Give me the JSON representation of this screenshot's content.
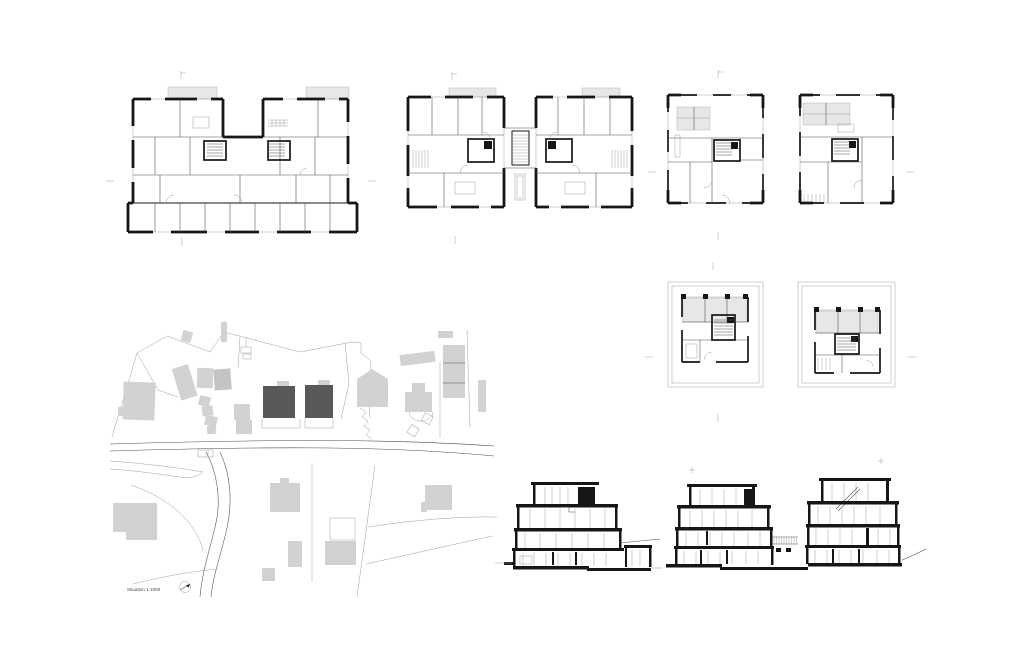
{
  "sheet": {
    "background": "#ffffff"
  },
  "colors": {
    "line": "#161616",
    "thin_line": "#4a4a4a",
    "hairline": "#9f9f9f",
    "roof_fill": "#e7e7e7",
    "context_building_fill": "#d2d2d2",
    "context_building_fill_dark": "#c4c4c4",
    "project_building_fill": "#595959"
  },
  "site_plan": {
    "caption": "Situation 1:1000"
  }
}
